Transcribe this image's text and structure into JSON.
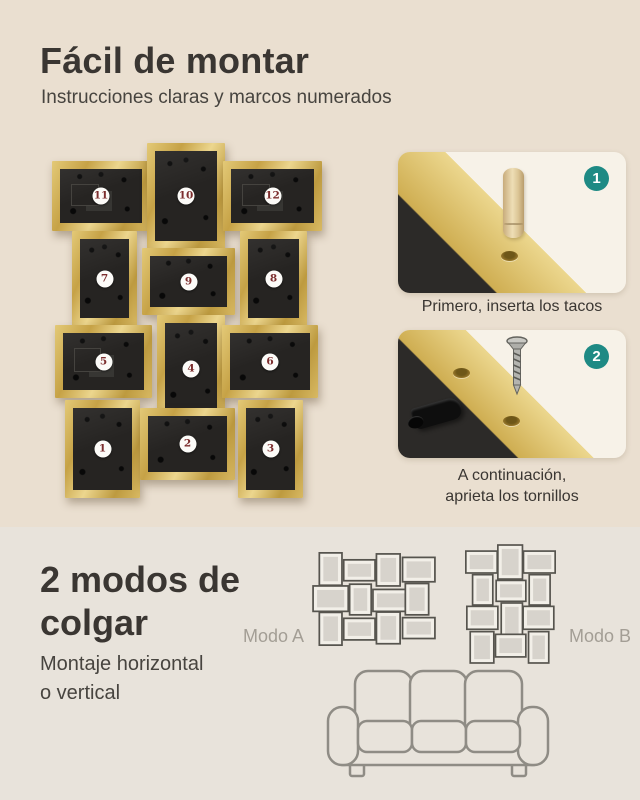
{
  "header": {
    "title": "Fácil de montar",
    "subtitle": "Instrucciones claras y marcos numerados"
  },
  "collage": {
    "frames": [
      {
        "n": "11"
      },
      {
        "n": "10"
      },
      {
        "n": "12"
      },
      {
        "n": "7"
      },
      {
        "n": "9"
      },
      {
        "n": "8"
      },
      {
        "n": "5"
      },
      {
        "n": "4"
      },
      {
        "n": "6"
      },
      {
        "n": "1"
      },
      {
        "n": "2"
      },
      {
        "n": "3"
      }
    ]
  },
  "steps": [
    {
      "badge": "1",
      "caption": "Primero, inserta los tacos"
    },
    {
      "badge": "2",
      "caption_line1": "A continuación,",
      "caption_line2": "aprieta los tornillos"
    }
  ],
  "hanging": {
    "title_line1": "2 modos de",
    "title_line2": "colgar",
    "subtitle_line1": "Montaje horizontal",
    "subtitle_line2": "o vertical",
    "mode_a_label": "Modo A",
    "mode_b_label": "Modo B"
  },
  "colors": {
    "background_top": "#eadfd0",
    "background_bottom": "#e8e3db",
    "frame_gold": "#cfae52",
    "frame_back": "#262422",
    "badge_teal": "#1e8a84",
    "frame_number_maroon": "#7c2d2d",
    "card_background": "#f7f2e8",
    "text_dark": "#3a3632",
    "mode_label_gray": "#a39e95",
    "diagram_line": "#56544e",
    "sofa_line": "#8f8c85"
  }
}
